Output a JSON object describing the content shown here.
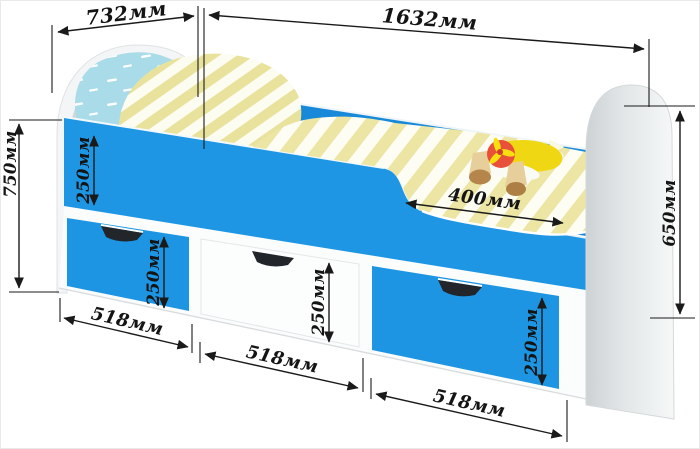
{
  "diagram": {
    "subject": "children's bed with guard rail and three storage drawers",
    "unit": "мм"
  },
  "dims": {
    "headboard_width": "732мм",
    "bed_length": "1632мм",
    "overall_height": "750мм",
    "footboard_height": "650мм",
    "guard_rail_height": "250мм",
    "entry_opening_width": "400мм",
    "drawer_left": {
      "height": "250мм",
      "width": "518мм"
    },
    "drawer_middle": {
      "height": "250мм",
      "width": "518мм"
    },
    "drawer_right": {
      "height": "250мм",
      "width": "518мм"
    }
  },
  "colors": {
    "bed_blue": "#1e96e3",
    "back_rail_blue": "#1789d8",
    "stripe_yellow": "#ece5a0",
    "pillow_blue": "#a9dbe8",
    "panel_gray": "#ced3d6",
    "plane_yellow": "#f0d713",
    "plane_red": "#e8503a",
    "wheel_brown": "#b5854b",
    "dimension_ink": "#1a1a1a",
    "background": "#ffffff"
  }
}
